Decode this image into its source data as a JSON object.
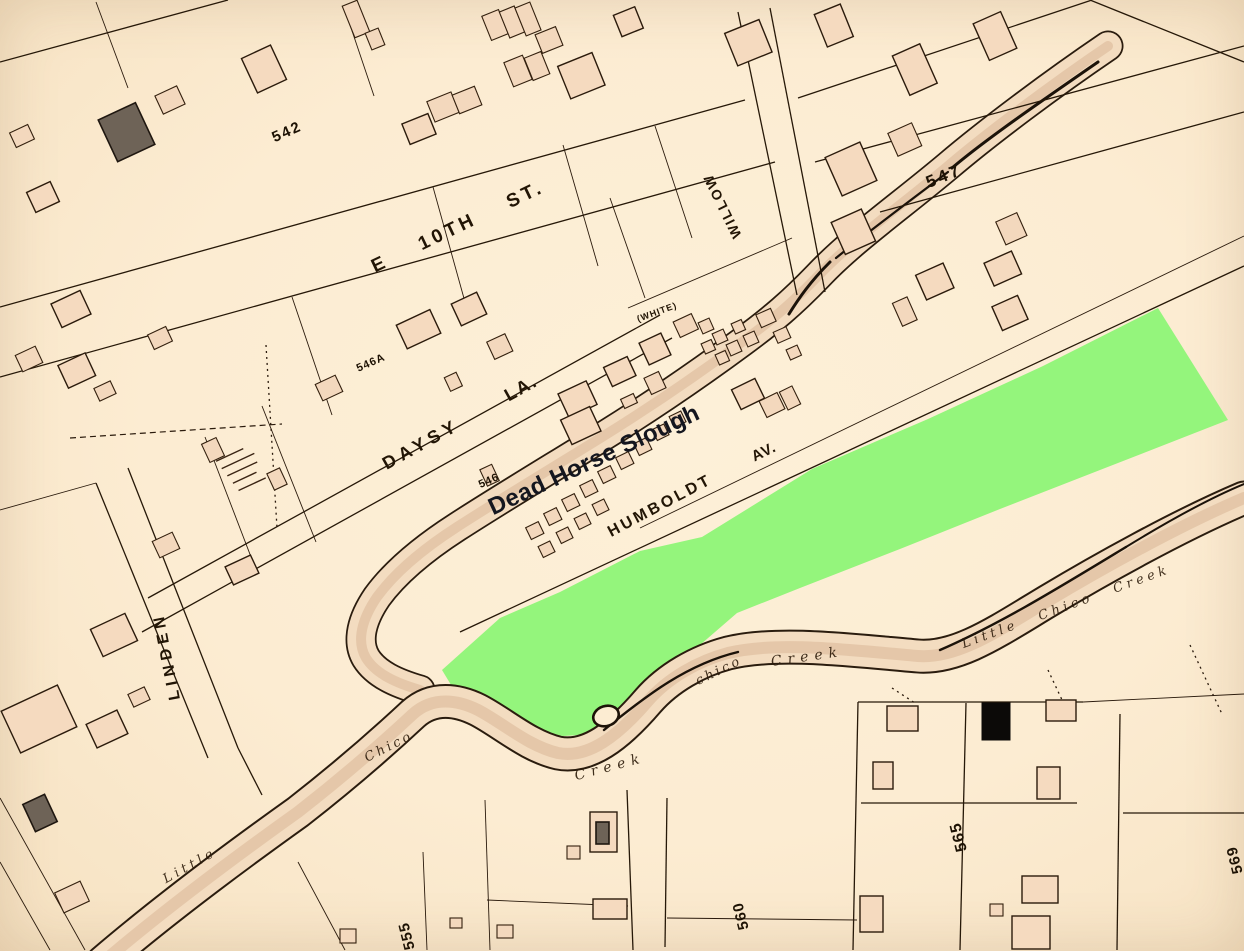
{
  "map": {
    "streets": {
      "e_10th": "E 10TH ST.",
      "willow": "WILLOW",
      "daysy": "DAYSY",
      "daysy_la": "LA.",
      "white": "(WHITE)",
      "humboldt": "HUMBOLDT",
      "humboldt_av": "AV.",
      "linden": "LINDEN"
    },
    "blocks": {
      "n542": "542",
      "n546": "546",
      "n546a": "546A",
      "n547": "547",
      "n555": "555",
      "n560": "560",
      "n565": "565",
      "n569": "569"
    },
    "waterways": {
      "dead_horse_slough": "Dead Horse Slough",
      "little_lower": "Little",
      "chico_lower": "Chico",
      "creek_lower": "Creek",
      "chico_mid": "chico",
      "creek_mid": "Creek",
      "little_chico_creek": "Little Chico Creek"
    },
    "colors": {
      "paper": "#fcecd2",
      "ink": "#261808",
      "building_fill": "#f5dabf",
      "highlight_green": "#94f57c",
      "water_tan": "#f3dcc0",
      "annotation_dark": "#14161f"
    }
  }
}
